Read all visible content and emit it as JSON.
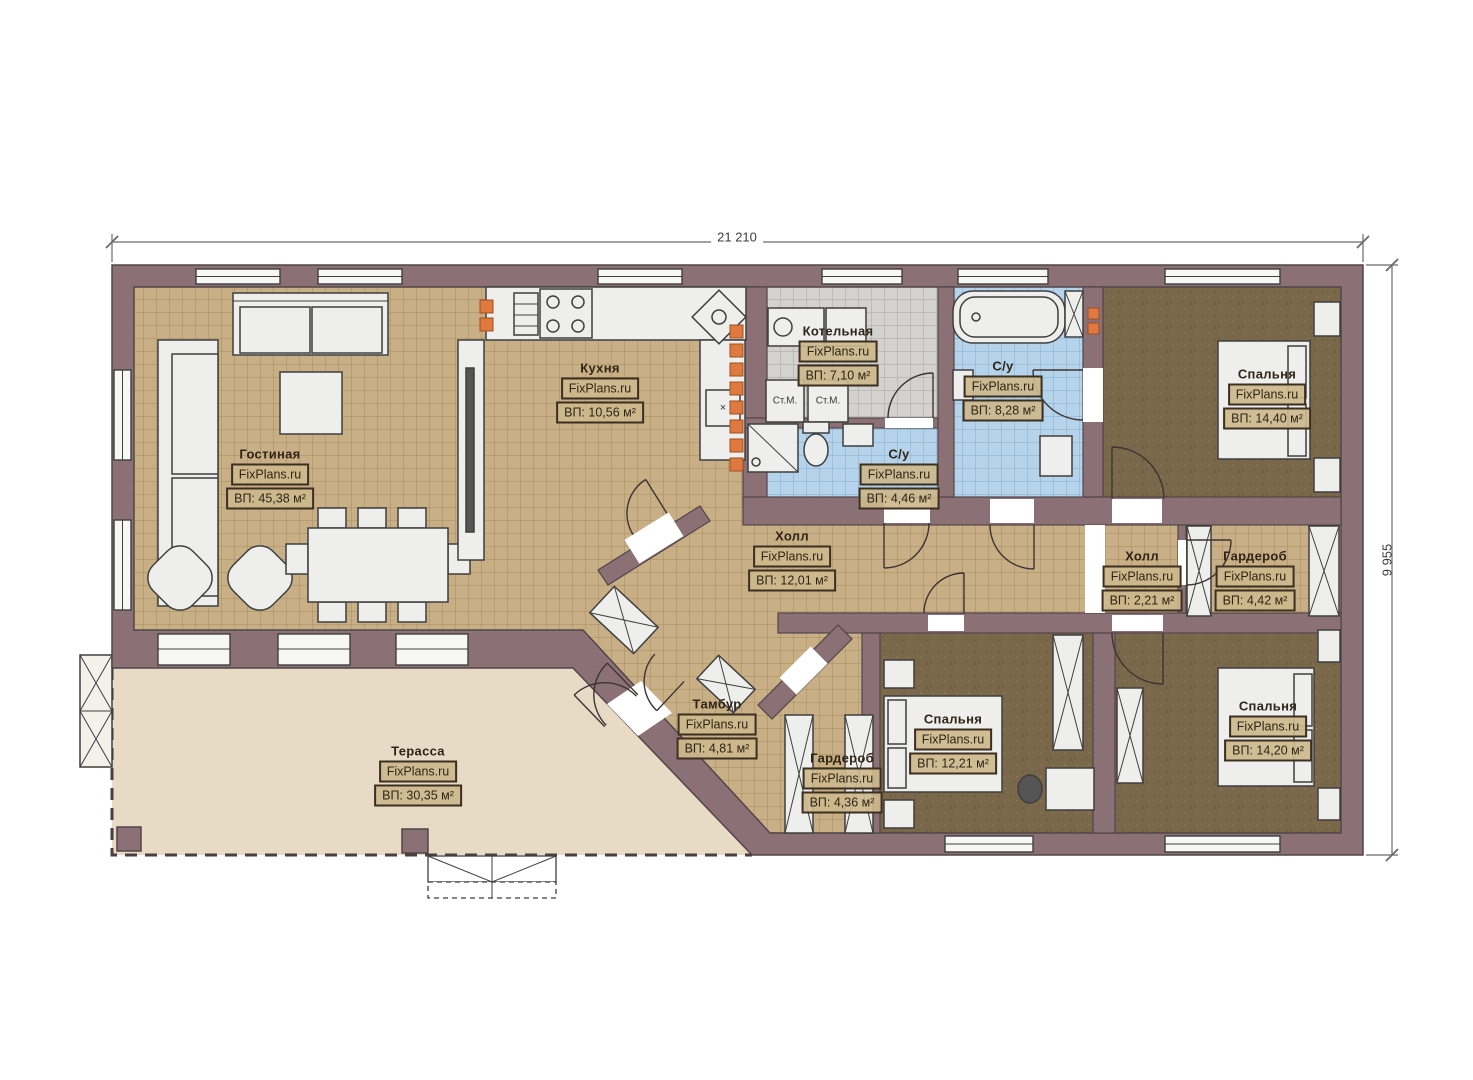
{
  "watermark": "FixPlans.ru",
  "dimensions": {
    "width": "21 210",
    "height": "9 955"
  },
  "rooms": [
    {
      "name": "Гостиная",
      "area": "ВП: 45,38 м²"
    },
    {
      "name": "Кухня",
      "area": "ВП: 10,56 м²"
    },
    {
      "name": "Котельная",
      "area": "ВП: 7,10 м²"
    },
    {
      "name": "С/у",
      "area": "ВП: 4,46 м²"
    },
    {
      "name": "С/у",
      "area": "ВП: 8,28 м²"
    },
    {
      "name": "Спальня",
      "area": "ВП: 14,40 м²"
    },
    {
      "name": "Холл",
      "area": "ВП: 12,01 м²"
    },
    {
      "name": "Холл",
      "area": "ВП: 2,21 м²"
    },
    {
      "name": "Гардероб",
      "area": "ВП: 4,42 м²"
    },
    {
      "name": "Тамбур",
      "area": "ВП: 4,81 м²"
    },
    {
      "name": "Гардероб",
      "area": "ВП: 4,36 м²"
    },
    {
      "name": "Спальня",
      "area": "ВП: 12,21 м²"
    },
    {
      "name": "Спальня",
      "area": "ВП: 14,20 м²"
    },
    {
      "name": "Терасса",
      "area": "ВП: 30,35 м²"
    }
  ],
  "fixtures": {
    "washer1": "Ст.М.",
    "washer2": "Ст.М.",
    "corner_mark": "×"
  },
  "colors": {
    "wall": "#8b7175",
    "wall_stroke": "#51454a",
    "tile_tan": "#c9af85",
    "tile_blue": "#b5d4ec",
    "tile_gray": "#d4d2cf",
    "carpet_brown": "#7a684a",
    "terrace": "#e7dbc5",
    "vent_orange": "#e0793f",
    "furniture": "#eeeeec"
  }
}
